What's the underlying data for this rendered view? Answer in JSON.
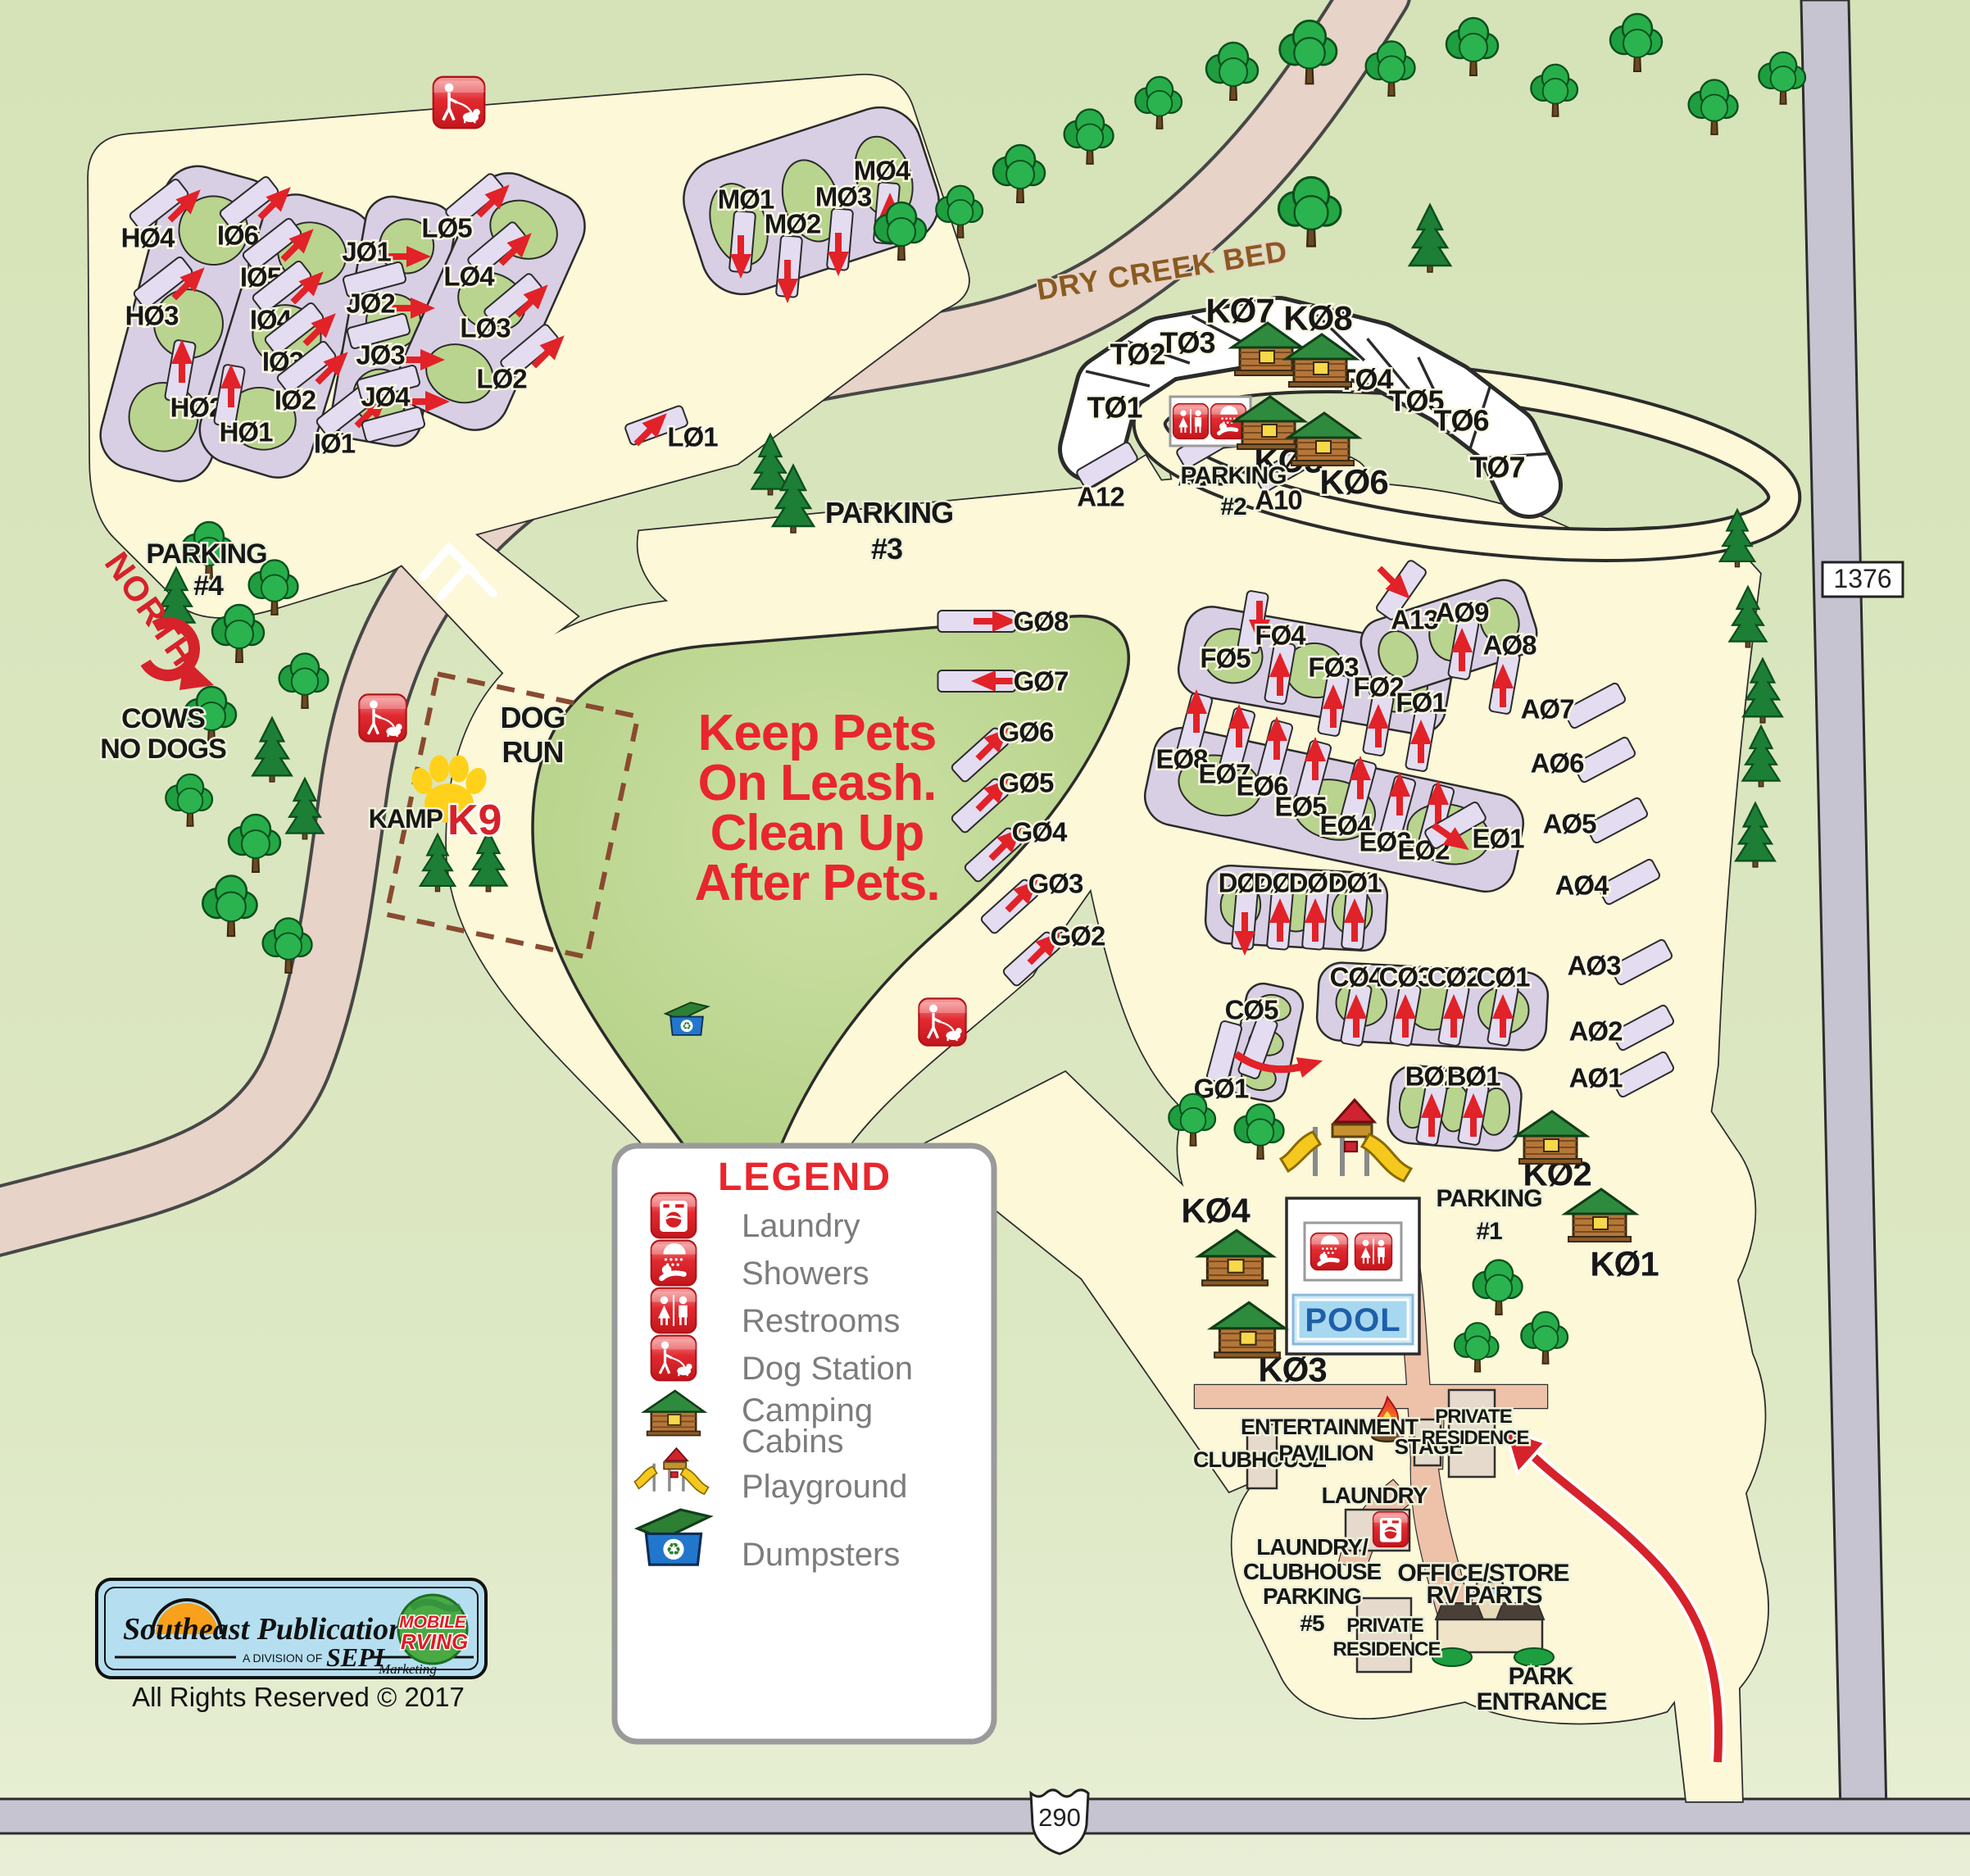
{
  "signs": {
    "north": "NORTH",
    "cows_line1": "COWS",
    "cows_line2": "NO DOGS",
    "dry_creek": "DRY CREEK BED",
    "route_290": "290",
    "route_1376": "1376"
  },
  "notice": {
    "line1": "Keep Pets",
    "line2": "On Leash.",
    "line3": "Clean Up",
    "line4": "After Pets."
  },
  "dog_run": {
    "line1": "DOG",
    "line2": "RUN",
    "kamp": "KAMP",
    "k9": "K9"
  },
  "parking": {
    "p1_line1": "PARKING",
    "p1_line2": "#1",
    "p2_line1": "PARKING",
    "p2_line2": "#2",
    "p3_line1": "PARKING",
    "p3_line2": "#3",
    "p4_line1": "PARKING",
    "p4_line2": "#4",
    "p5_line1": "LAUNDRY/",
    "p5_line2": "CLUBHOUSE",
    "p5_line3": "PARKING",
    "p5_line4": "#5"
  },
  "facilities": {
    "clubhouse": "CLUBHOUSE",
    "pavilion_line1": "ENTERTAINMENT",
    "pavilion_line2": "PAVILION",
    "stage": "STAGE",
    "private_residence_line1": "PRIVATE",
    "private_residence_line2": "RESIDENCE",
    "laundry": "LAUNDRY",
    "office_line1": "OFFICE/STORE",
    "office_line2": "RV PARTS",
    "park_entrance_line1": "PARK",
    "park_entrance_line2": "ENTRANCE",
    "pool": "POOL"
  },
  "legend": {
    "title": "LEGEND",
    "items": [
      {
        "icon": "laundry-icon",
        "label": "Laundry"
      },
      {
        "icon": "shower-icon",
        "label": "Showers"
      },
      {
        "icon": "restroom-icon",
        "label": "Restrooms"
      },
      {
        "icon": "dog-station-icon",
        "label": "Dog Station"
      },
      {
        "icon": "cabin-icon",
        "label": "Camping",
        "label2": "Cabins"
      },
      {
        "icon": "playground-icon",
        "label": "Playground"
      },
      {
        "icon": "dumpster-icon",
        "label": "Dumpsters"
      }
    ]
  },
  "footer": {
    "brand": "Southeast Publications",
    "division": "A DIVISION OF",
    "sepi": "SEPI",
    "marketing": "Marketing",
    "mobile_line1": "MOBILE",
    "mobile_line2": "RVING",
    "rights": "All Rights Reserved © 2017"
  },
  "sites": {
    "H01": "HØ1",
    "H02": "HØ2",
    "H03": "HØ3",
    "H04": "HØ4",
    "I01": "IØ1",
    "I02": "IØ2",
    "I03": "IØ3",
    "I04": "IØ4",
    "I05": "IØ5",
    "I06": "IØ6",
    "J01": "JØ1",
    "J02": "JØ2",
    "J03": "JØ3",
    "J04": "JØ4",
    "L01": "LØ1",
    "L02": "LØ2",
    "L03": "LØ3",
    "L04": "LØ4",
    "L05": "LØ5",
    "M01": "MØ1",
    "M02": "MØ2",
    "M03": "MØ3",
    "M04": "MØ4",
    "T01": "TØ1",
    "T02": "TØ2",
    "T03": "TØ3",
    "T04": "TØ4",
    "T05": "TØ5",
    "T06": "TØ6",
    "T07": "TØ7",
    "A01": "AØ1",
    "A02": "AØ2",
    "A03": "AØ3",
    "A04": "AØ4",
    "A05": "AØ5",
    "A06": "AØ6",
    "A07": "AØ7",
    "A08": "AØ8",
    "A09": "AØ9",
    "A10": "A10",
    "A11": "A11",
    "A12": "A12",
    "A13": "A13",
    "B01": "BØ1",
    "B02": "BØ2",
    "C01": "CØ1",
    "C02": "CØ2",
    "C03": "CØ3",
    "C04": "CØ4",
    "C05": "CØ5",
    "D01": "DØ1",
    "D02": "DØ2",
    "D03": "DØ3",
    "D04": "DØ4",
    "E01": "EØ1",
    "E02": "EØ2",
    "E03": "EØ3",
    "E04": "EØ4",
    "E05": "EØ5",
    "E06": "EØ6",
    "E07": "EØ7",
    "E08": "EØ8",
    "F01": "FØ1",
    "F02": "FØ2",
    "F03": "FØ3",
    "F04": "FØ4",
    "F05": "FØ5",
    "G01": "GØ1",
    "G02": "GØ2",
    "G03": "GØ3",
    "G04": "GØ4",
    "G05": "GØ5",
    "G06": "GØ6",
    "G07": "GØ7",
    "G08": "GØ8",
    "K01": "KØ1",
    "K02": "KØ2",
    "K03": "KØ3",
    "K04": "KØ4",
    "K05": "KØ5",
    "K06": "KØ6",
    "K07": "KØ7",
    "K08": "KØ8"
  }
}
